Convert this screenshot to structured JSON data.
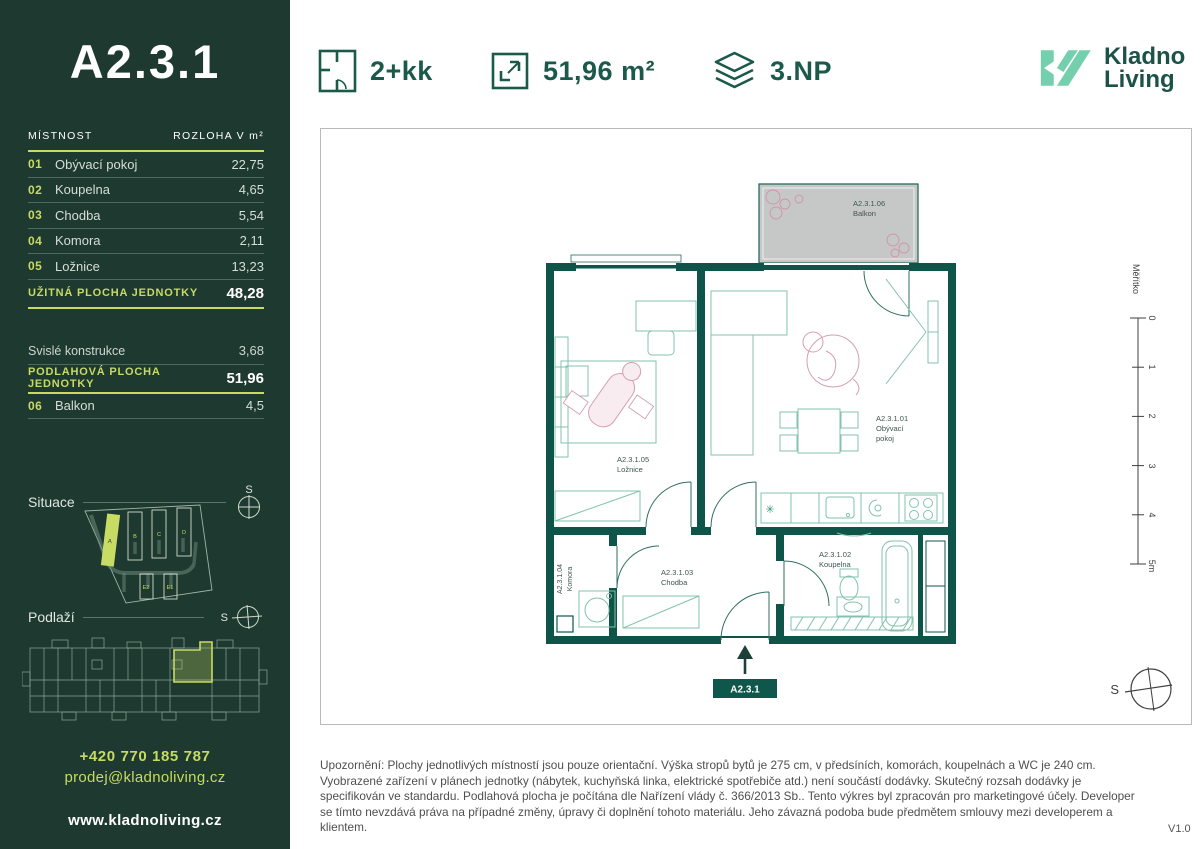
{
  "header": {
    "unit_id": "A2.3.1",
    "features": [
      {
        "icon": "floorplan-icon",
        "label": "2+kk"
      },
      {
        "icon": "area-icon",
        "label": "51,96 m²"
      },
      {
        "icon": "floor-icon",
        "label": "3.NP"
      }
    ],
    "brand": {
      "line1": "Kladno",
      "line2": "Living"
    }
  },
  "room_table": {
    "col_room": "MÍSTNOST",
    "col_area": "ROZLOHA V m²",
    "rows": [
      {
        "num": "01",
        "name": "Obývací pokoj",
        "area": "22,75"
      },
      {
        "num": "02",
        "name": "Koupelna",
        "area": "4,65"
      },
      {
        "num": "03",
        "name": "Chodba",
        "area": "5,54"
      },
      {
        "num": "04",
        "name": "Komora",
        "area": "2,11"
      },
      {
        "num": "05",
        "name": "Ložnice",
        "area": "13,23"
      }
    ],
    "usable": {
      "label": "UŽITNÁ PLOCHA JEDNOTKY",
      "value": "48,28"
    },
    "vertical": {
      "label": "Svislé konstrukce",
      "value": "3,68"
    },
    "floor_area": {
      "label": "PODLAHOVÁ PLOCHA JEDNOTKY",
      "value": "51,96"
    },
    "balcony": {
      "num": "06",
      "name": "Balkon",
      "value": "4,5"
    }
  },
  "situace": {
    "title": "Situace",
    "compass": "S",
    "buildings": [
      "A",
      "B",
      "C",
      "D",
      "E2",
      "E1"
    ]
  },
  "podlazi": {
    "title": "Podlaží",
    "compass": "S"
  },
  "contact": {
    "phone": "+420 770 185 787",
    "email": "prodej@kladnoliving.cz",
    "web": "www.kladnoliving.cz"
  },
  "plan": {
    "badge": "A2.3.1",
    "compass": "S",
    "scale": {
      "label": "Měřítko",
      "ticks": [
        "0",
        "1",
        "2",
        "3",
        "4",
        "5m"
      ]
    },
    "labels": {
      "living": [
        "A2.3.1.01",
        "Obývací",
        "pokoj"
      ],
      "bath": [
        "A2.3.1.02",
        "Koupelna"
      ],
      "hall": [
        "A2.3.1.03",
        "Chodba"
      ],
      "closet": [
        "A2.3.1.04",
        "Komora"
      ],
      "bedroom": [
        "A2.3.1.05",
        "Ložnice"
      ],
      "balcony": [
        "A2.3.1.06",
        "Balkon"
      ]
    }
  },
  "footer": {
    "disclaimer": "Upozornění: Plochy jednotlivých místností jsou pouze orientační. Výška stropů bytů je 275 cm, v předsíních, komorách, koupelnách a WC je 240 cm. Vyobrazené zařízení v plánech jednotky (nábytek, kuchyňská linka, elektrické spotřebiče atd.) není součástí dodávky. Skutečný rozsah dodávky je specifikován ve standardu. Podlahová plocha je počítána dle Nařízení vlády č. 366/2013 Sb.. Tento výkres byl zpracován pro marketingové účely. Developer se tímto nevzdává práva na případné změny, úpravy či doplnění tohoto materiálu. Jeho závazná podoba bude předmětem smlouvy mezi developerem a klientem.",
    "version": "V1.0"
  },
  "colors": {
    "sidebar_bg": "#1e3930",
    "accent_lime": "#c7da62",
    "brand_green": "#1b5a4a",
    "wall_green": "#0f5448",
    "furniture_teal": "#83c2ae",
    "illustration_pink": "#d49fb4",
    "balcony_gray": "#c6c8c7"
  }
}
